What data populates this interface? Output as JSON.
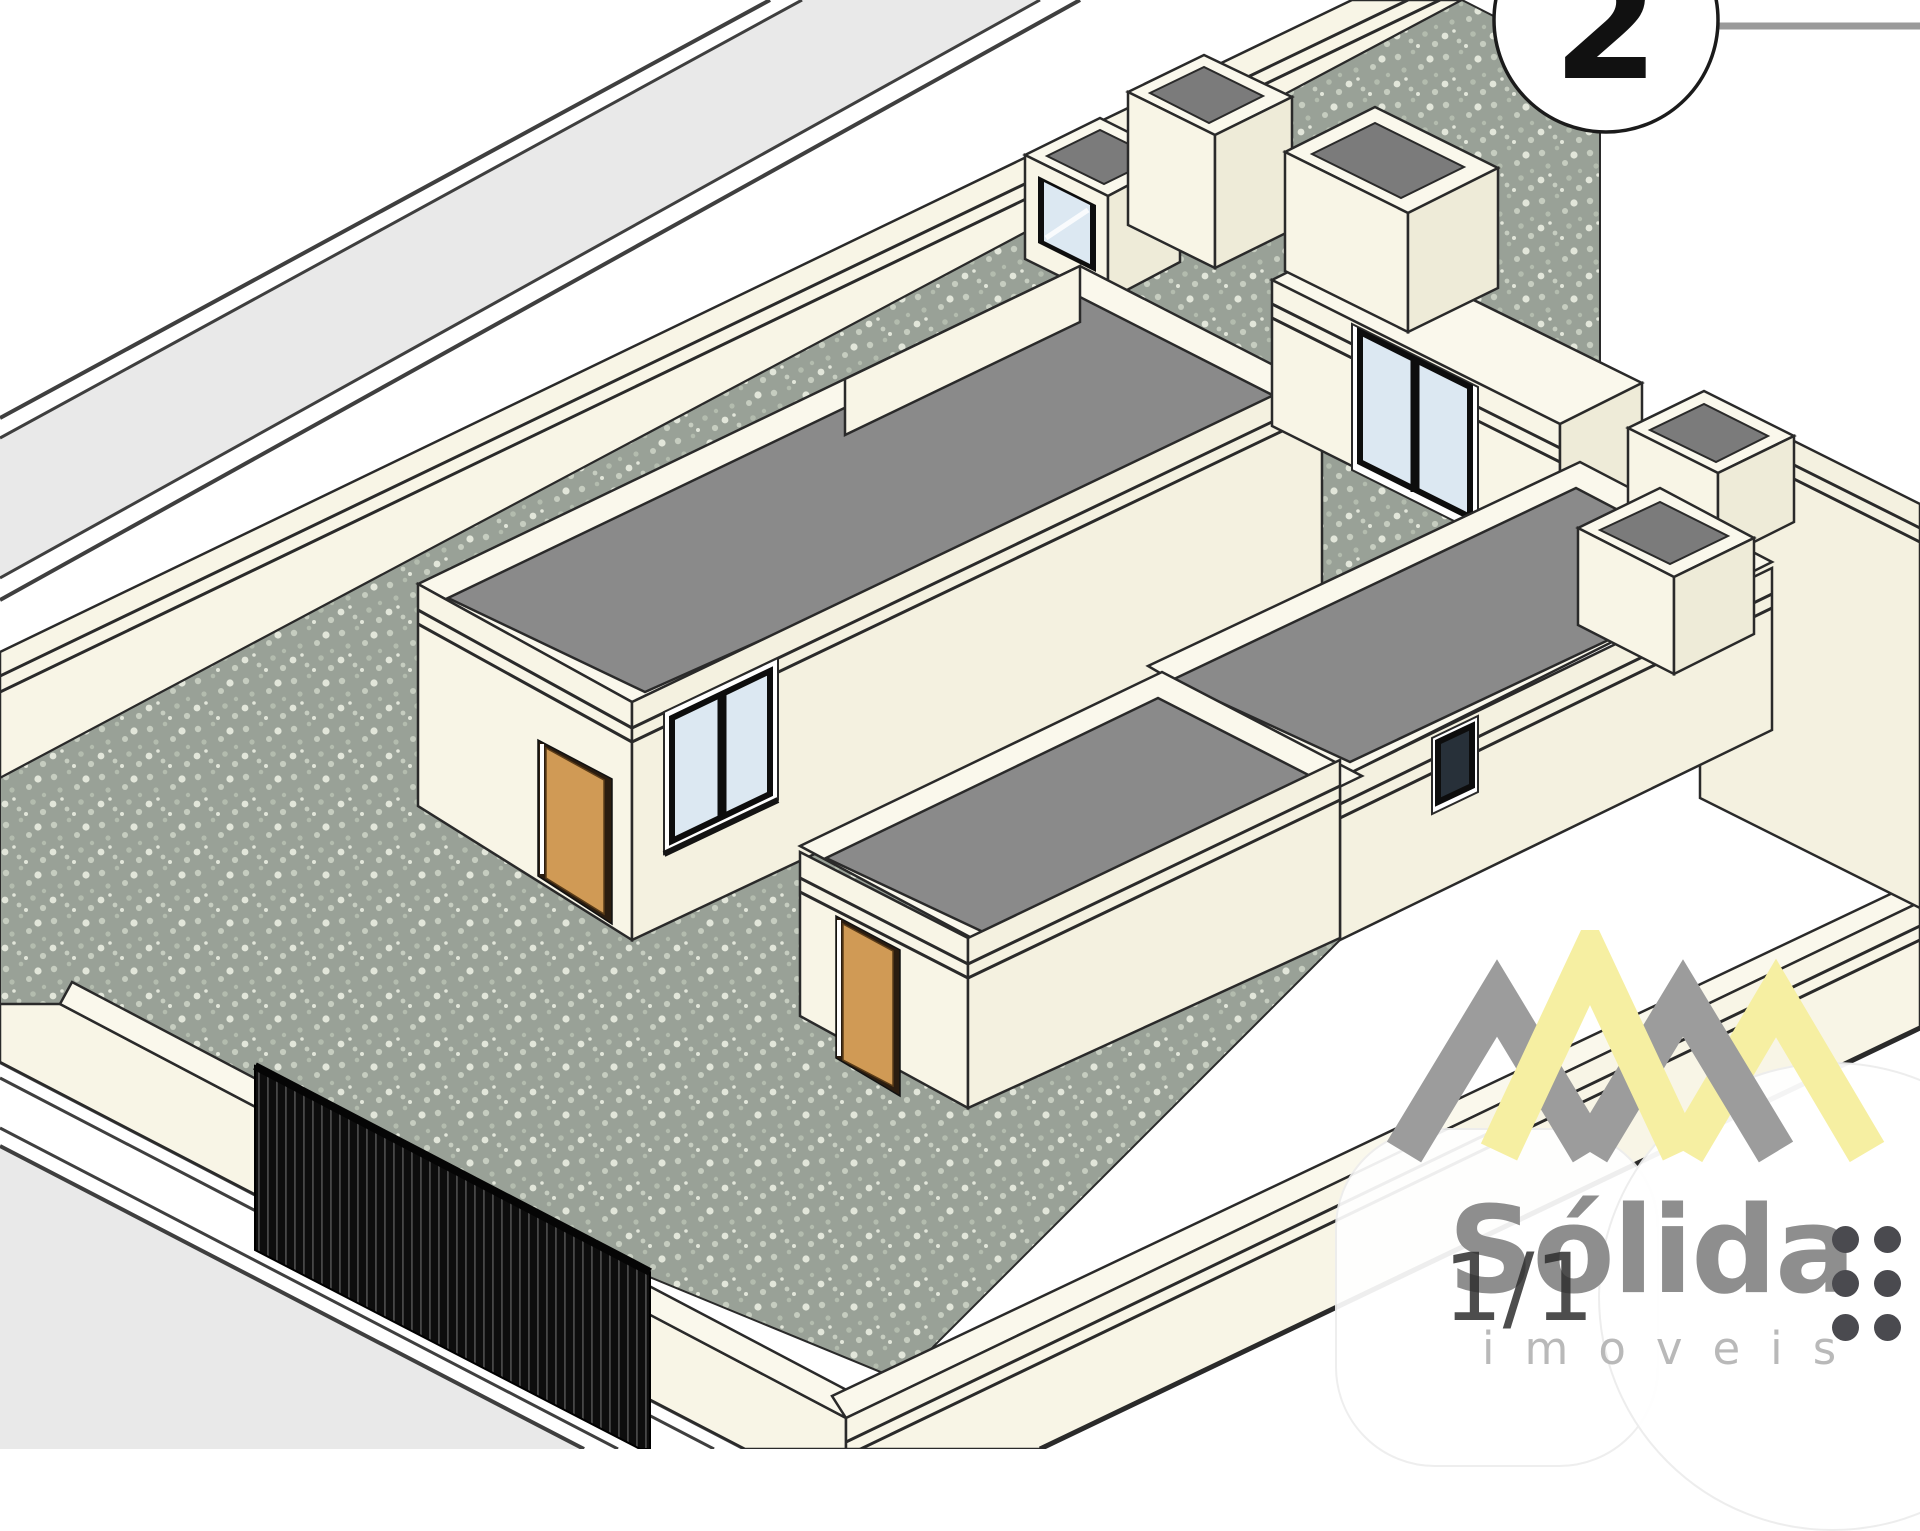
{
  "callout": {
    "number": "2",
    "meaning": "drawing-view-callout"
  },
  "page_indicator": {
    "text": "1/1"
  },
  "watermark": {
    "brand": "Sólida",
    "tagline": "imoveis",
    "logo": "double-mountain-monogram",
    "dot_grid": {
      "rows": 3,
      "cols": 2
    }
  },
  "scene": {
    "type": "axonometric-architectural-rendering",
    "elements": [
      "street-band-top-left",
      "street-band-bottom-left",
      "perimeter-wall-back",
      "perimeter-wall-front-left",
      "perimeter-wall-front-right",
      "perimeter-wall-right",
      "courtyard-speckled-ground",
      "entry-gate-bars",
      "left-house-flat-roof",
      "left-house-entry-door",
      "left-house-front-window",
      "left-house-upper-window",
      "left-roof-stair-box",
      "left-roof-tower",
      "right-house-flat-roof",
      "right-house-entry-door",
      "right-house-upper-window",
      "right-house-slit-window",
      "right-roof-tower",
      "right-roof-planter-boxes"
    ]
  },
  "colors": {
    "wall_lit": "#f8f5e6",
    "wall_lit2": "#f4f1e0",
    "wall_top": "#faf8ec",
    "wall_shade": "#eeebd8",
    "roof": "#8a8a8a",
    "roof_dark": "#7b7b7b",
    "street": "#e9e9e9",
    "street_line": "#3f3f3f",
    "line": "#2a2a2a",
    "ground": "#99a197",
    "speck1": "#c6cdc0",
    "speck2": "#b3bcae",
    "speck3": "#e2e6da",
    "door": "#d09a55",
    "door_frame": "#2b1d10",
    "glass": "#dce8f2",
    "glass_dark": "#273039",
    "gate": "#0d0d0d",
    "gate_bar": "#474747",
    "brand_gray": "#8e8e8e",
    "brand_yellow": "#f6efa2",
    "logo_gray": "#9c9c9c",
    "text_dark": "#2e2e2e",
    "tagline_gray": "#b9b9b9",
    "dot_gray": "#4a4a4f"
  }
}
